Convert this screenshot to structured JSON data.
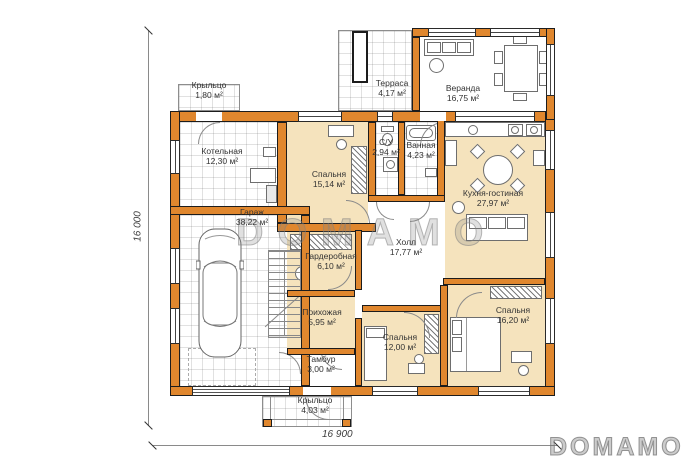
{
  "plan": {
    "watermark": "DOMAMO",
    "logo": "DOMAMO",
    "dimensions": {
      "height_label": "16 000",
      "width_label": "16 900"
    },
    "colors": {
      "wall": "#e0872e",
      "room": "#f5e3bd"
    },
    "rooms": [
      {
        "name": "Крыльцо",
        "area": "1,80 м²"
      },
      {
        "name": "Котельная",
        "area": "12,30 м²"
      },
      {
        "name": "Гараж",
        "area": "38,22 м²"
      },
      {
        "name": "Спальня",
        "area": "15,14 м²"
      },
      {
        "name": "С/У",
        "area": "2,94 м²"
      },
      {
        "name": "Ванная",
        "area": "4,23 м²"
      },
      {
        "name": "Терраса",
        "area": "4,17 м²"
      },
      {
        "name": "Веранда",
        "area": "16,75 м²"
      },
      {
        "name": "Кухня-гостиная",
        "area": "27,97 м²"
      },
      {
        "name": "Холл",
        "area": "17,77 м²"
      },
      {
        "name": "Гардеробная",
        "area": "6,10 м²"
      },
      {
        "name": "Прихожая",
        "area": "5,95 м²"
      },
      {
        "name": "Тамбур",
        "area": "3,00 м²"
      },
      {
        "name": "Спальня",
        "area": "12,00 м²"
      },
      {
        "name": "Спальня",
        "area": "16,20 м²"
      },
      {
        "name": "Крыльцо",
        "area": "4,03 м²"
      }
    ]
  }
}
